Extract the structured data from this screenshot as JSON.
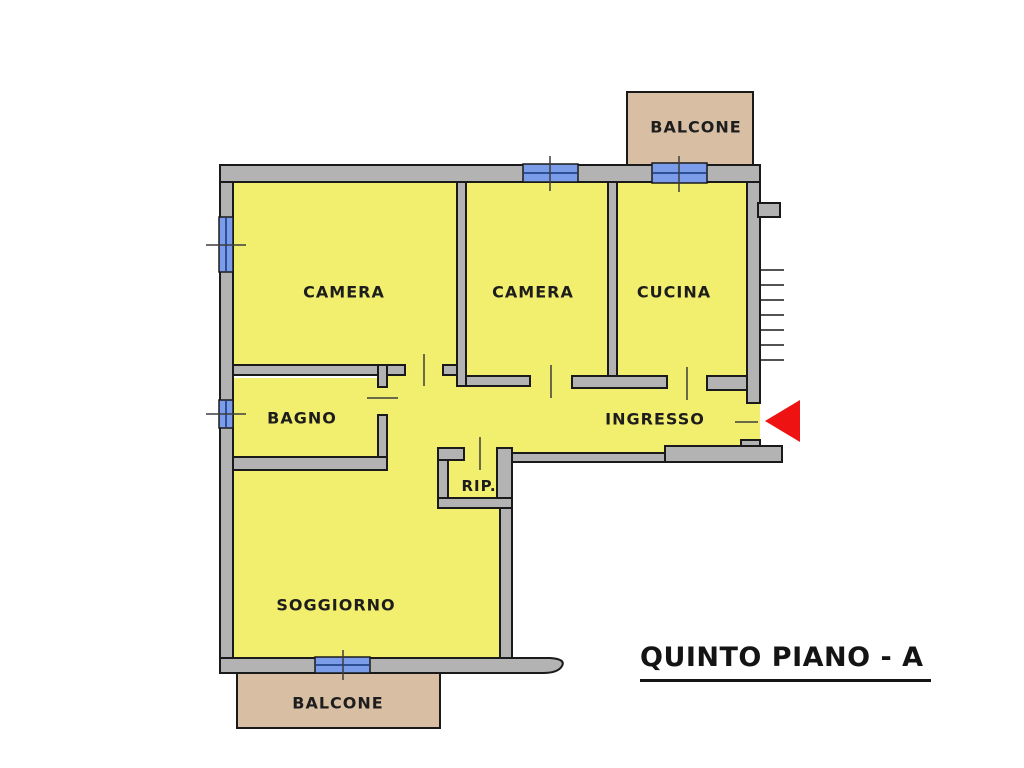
{
  "title": {
    "text": "QUINTO PIANO - A"
  },
  "rooms": [
    {
      "id": "camera-1",
      "label": "CAMERA"
    },
    {
      "id": "camera-2",
      "label": "CAMERA"
    },
    {
      "id": "cucina",
      "label": "CUCINA"
    },
    {
      "id": "bagno",
      "label": "BAGNO"
    },
    {
      "id": "ingresso",
      "label": "INGRESSO"
    },
    {
      "id": "rip",
      "label": "RIP."
    },
    {
      "id": "soggiorno",
      "label": "SOGGIORNO"
    },
    {
      "id": "balcone-top",
      "label": "BALCONE"
    },
    {
      "id": "balcone-bottom",
      "label": "BALCONE"
    }
  ],
  "entrance": {
    "marker": "red-triangle-arrow",
    "direction": "left"
  },
  "colors": {
    "room_fill": "#f2ee6e",
    "wall_fill": "#b3b3b3",
    "wall_line": "#1a1a1a",
    "window_fill": "#7b9ce8",
    "window_line": "#2e4f96",
    "balcony_fill": "#d8bfa4",
    "arrow_red": "#ee1212",
    "text": "#1d1d1d",
    "background": "#ffffff"
  }
}
